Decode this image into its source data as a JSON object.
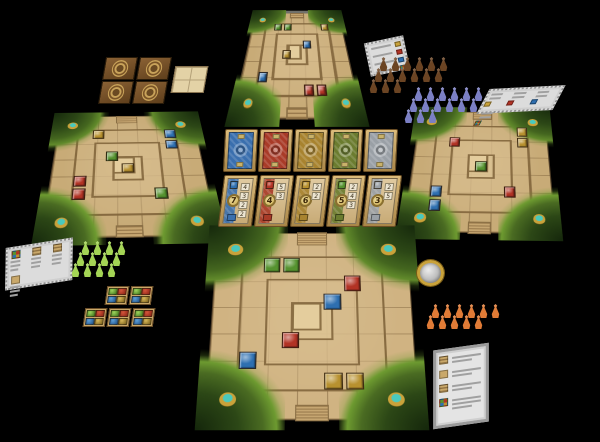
{
  "scene": {
    "description": "Tabletop photo of a jungle pyramid tile-laying board game set up for four players",
    "background": "#000000"
  },
  "palette": {
    "board_sand": "#c8ab77",
    "board_line": "#8a6f45",
    "jungle_dark": "#16290c",
    "jungle_light": "#618a2b",
    "gem_red": "#b23325",
    "gem_green": "#55922f",
    "gem_blue": "#2e6fb0",
    "gem_gold": "#b8912f",
    "gem_silver": "#9aa0a6",
    "temple_blue": "#3a6fae",
    "temple_red": "#a93b28",
    "temple_gold": "#a8832f",
    "temple_green": "#6b7c2f",
    "temple_silver": "#9aa0a6",
    "meeple_brown": "#6b4423",
    "meeple_purple": "#7b7fc4",
    "meeple_green": "#a4d455",
    "meeple_orange": "#e07b36",
    "altar_teal": "#35b5ac",
    "wood_tray": "#c8a55e",
    "card_tan": "#d8c08a",
    "coin_gold": "#c9a23a",
    "coin_silver": "#cdcdcd",
    "refcard_grey": "#dcdcdc"
  },
  "boards": [
    {
      "id": "top",
      "gems": [
        {
          "color": "green",
          "row": 0,
          "col": 1
        },
        {
          "color": "green",
          "row": 0,
          "col": 2
        },
        {
          "color": "gold",
          "row": 0,
          "col": 6
        },
        {
          "color": "blue",
          "row": 2,
          "col": 4
        },
        {
          "color": "gold",
          "row": 3,
          "col": 2
        },
        {
          "color": "blue",
          "row": 5,
          "col": 0
        },
        {
          "color": "red",
          "row": 6,
          "col": 4
        },
        {
          "color": "red",
          "row": 6,
          "col": 5
        }
      ]
    },
    {
      "id": "left",
      "gems": [
        {
          "color": "gold",
          "row": 0,
          "col": 1
        },
        {
          "color": "blue",
          "row": 0,
          "col": 6
        },
        {
          "color": "blue",
          "row": 1,
          "col": 6
        },
        {
          "color": "green",
          "row": 2,
          "col": 2
        },
        {
          "color": "gold",
          "row": 3,
          "col": 3
        },
        {
          "color": "red",
          "row": 4,
          "col": 0
        },
        {
          "color": "red",
          "row": 5,
          "col": 0
        },
        {
          "color": "green",
          "row": 5,
          "col": 5
        }
      ]
    },
    {
      "id": "right",
      "gems": [
        {
          "color": "gold",
          "row": 0,
          "col": 6
        },
        {
          "color": "gold",
          "row": 1,
          "col": 6
        },
        {
          "color": "red",
          "row": 1,
          "col": 1
        },
        {
          "color": "green",
          "row": 3,
          "col": 3
        },
        {
          "color": "blue",
          "row": 5,
          "col": 0
        },
        {
          "color": "blue",
          "row": 6,
          "col": 0
        },
        {
          "color": "red",
          "row": 5,
          "col": 5
        }
      ]
    },
    {
      "id": "bottom",
      "gems": [
        {
          "color": "green",
          "row": 0,
          "col": 1
        },
        {
          "color": "green",
          "row": 0,
          "col": 2
        },
        {
          "color": "red",
          "row": 1,
          "col": 5
        },
        {
          "color": "blue",
          "row": 2,
          "col": 4
        },
        {
          "color": "red",
          "row": 4,
          "col": 2
        },
        {
          "color": "blue",
          "row": 5,
          "col": 0
        },
        {
          "color": "gold",
          "row": 6,
          "col": 4
        },
        {
          "color": "gold",
          "row": 6,
          "col": 5
        }
      ]
    }
  ],
  "market": {
    "temple_cards": [
      {
        "gem": "blue",
        "color": "#3a6fae"
      },
      {
        "gem": "red",
        "color": "#a93b28"
      },
      {
        "gem": "gold",
        "color": "#a8832f"
      },
      {
        "gem": "green",
        "color": "#6b7c2f"
      },
      {
        "gem": "silver",
        "color": "#9aa0a6"
      }
    ],
    "value_cards": [
      {
        "gem": "blue",
        "value": "7",
        "steps": [
          "4",
          "3",
          "2",
          "2"
        ]
      },
      {
        "gem": "red",
        "value": "4",
        "steps": [
          "5",
          "3"
        ]
      },
      {
        "gem": "gold",
        "value": "6",
        "steps": [
          "2",
          "2"
        ]
      },
      {
        "gem": "green",
        "value": "5",
        "steps": [
          "2",
          "4",
          "3"
        ]
      },
      {
        "gem": "silver",
        "value": "3",
        "steps": [
          "2",
          "5"
        ]
      }
    ]
  },
  "meeples": {
    "groups": [
      {
        "color_name": "brown",
        "hex": "#6b4423",
        "count": 15
      },
      {
        "color_name": "purple",
        "hex": "#7b7fc4",
        "count": 15
      },
      {
        "color_name": "green",
        "hex": "#a4d455",
        "count": 12
      },
      {
        "color_name": "orange",
        "hex": "#e07b36",
        "count": 11
      }
    ]
  },
  "supply": {
    "emblem_tiles_count": 4,
    "blank_grid_tile_count": 1,
    "gem_quad_tiles_count": 5,
    "gem_quad_order": [
      "green",
      "red",
      "blue",
      "gold"
    ],
    "coin": {
      "ring": "#c9a23a",
      "center": "#cdcdcd"
    }
  },
  "reference_cards": [
    {
      "id": "aid-near-brown"
    },
    {
      "id": "aid-top-right"
    },
    {
      "id": "aid-left"
    },
    {
      "id": "aid-bottom-right"
    }
  ]
}
